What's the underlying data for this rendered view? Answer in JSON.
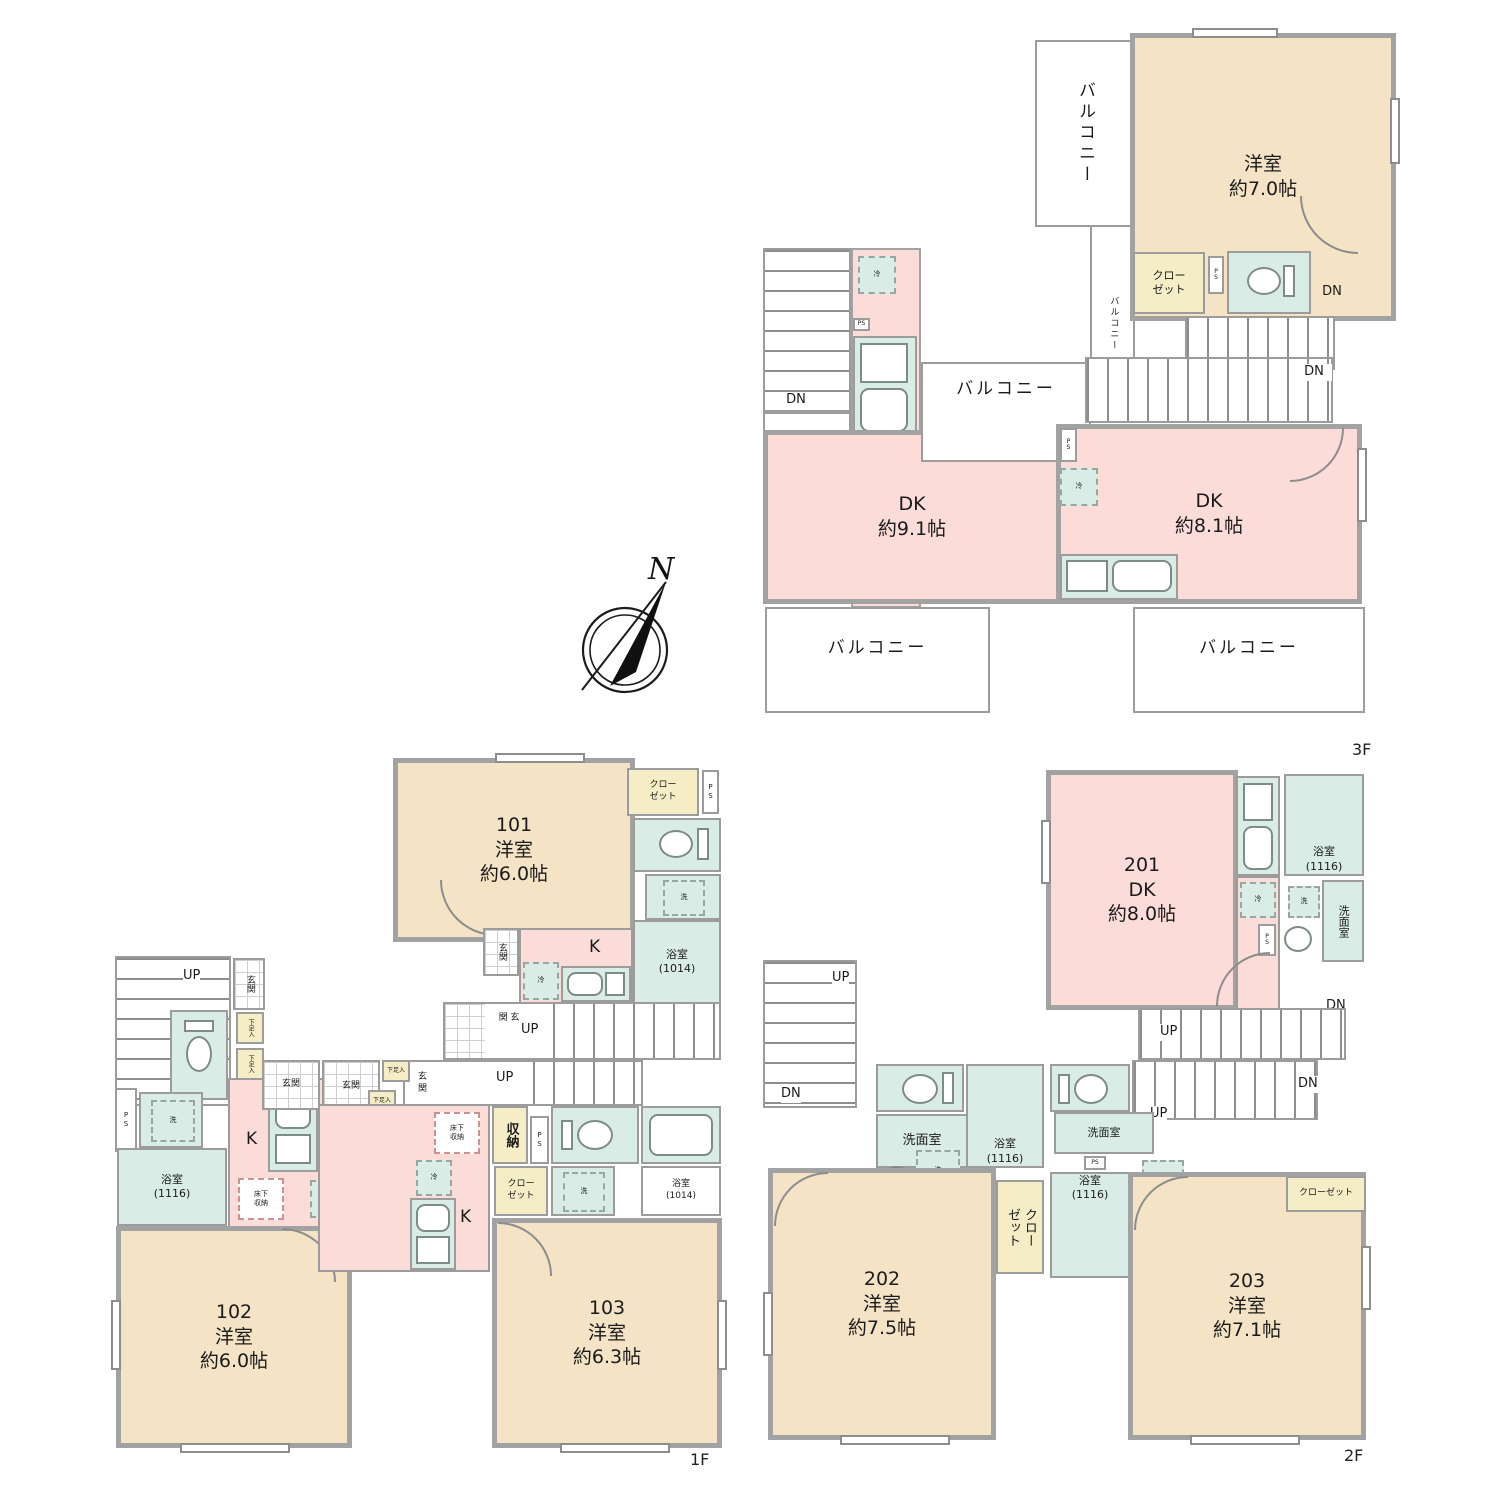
{
  "compass": {
    "north": "N"
  },
  "common": {
    "up": "UP",
    "dn": "DN",
    "ps_v": "P\nS",
    "ps": "PS",
    "genkan": "玄関",
    "laundry": "洗",
    "fridge": "冷",
    "balcony": "バルコニー",
    "closet_2line": "クロー\nゼット",
    "closet": "クローゼット",
    "floor_storage": "床下\n収納",
    "storage": "収納",
    "shoe_box": "下足入",
    "washroom": "洗面室",
    "bath_1014": "浴室\n(1014)",
    "bath_1116": "浴室\n(1116)",
    "kitchen": "K"
  },
  "floor3": {
    "floor_label": "3F",
    "western_room": "洋室\n約7.0帖",
    "dk_left": "DK\n約9.1帖",
    "dk_right": "DK\n約8.1帖"
  },
  "floor1": {
    "floor_label": "1F",
    "room101": "101\n洋室\n約6.0帖",
    "room102": "102\n洋室\n約6.0帖",
    "room103": "103\n洋室\n約6.3帖"
  },
  "floor2": {
    "floor_label": "2F",
    "room201": "201\nDK\n約8.0帖",
    "room202": "202\n洋室\n約7.5帖",
    "room203": "203\n洋室\n約7.1帖"
  }
}
